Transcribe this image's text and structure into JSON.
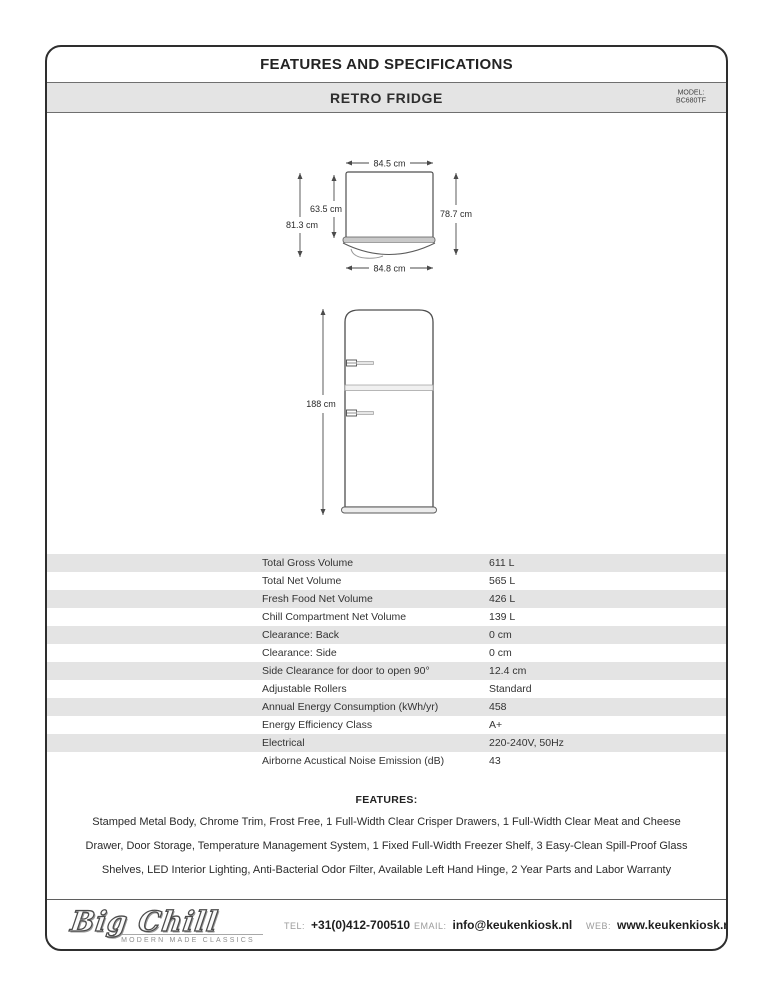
{
  "header": {
    "title": "FEATURES AND SPECIFICATIONS"
  },
  "product_bar": {
    "name": "RETRO FRIDGE",
    "model_label": "MODEL:",
    "model_value": "BC680TF"
  },
  "drawings": {
    "plan": {
      "width_top": "84.5 cm",
      "depth_body": "63.5 cm",
      "depth_total": "81.3 cm",
      "depth_right": "78.7 cm",
      "width_bottom": "84.8 cm"
    },
    "front": {
      "height": "188 cm"
    }
  },
  "specs": {
    "rows": [
      {
        "label": "Total Gross Volume",
        "value": "611 L"
      },
      {
        "label": "Total Net Volume",
        "value": "565 L"
      },
      {
        "label": "Fresh Food Net Volume",
        "value": "426 L"
      },
      {
        "label": "Chill Compartment Net Volume",
        "value": "139 L"
      },
      {
        "label": "Clearance: Back",
        "value": "0 cm"
      },
      {
        "label": "Clearance: Side",
        "value": "0 cm"
      },
      {
        "label": "Side Clearance for door to open 90°",
        "value": "12.4 cm"
      },
      {
        "label": "Adjustable Rollers",
        "value": "Standard"
      },
      {
        "label": "Annual Energy Consumption (kWh/yr)",
        "value": "458"
      },
      {
        "label": "Energy Efficiency Class",
        "value": "A+"
      },
      {
        "label": "Electrical",
        "value": "220-240V, 50Hz"
      },
      {
        "label": "Airborne Acustical Noise Emission (dB)",
        "value": "43"
      }
    ]
  },
  "features": {
    "heading": "FEATURES:",
    "text": "Stamped Metal Body, Chrome Trim, Frost Free, 1 Full-Width Clear Crisper Drawers, 1 Full-Width Clear Meat and Cheese Drawer, Door Storage, Temperature Management System, 1 Fixed Full-Width Freezer Shelf, 3 Easy-Clean Spill-Proof Glass Shelves, LED Interior Lighting, Anti-Bacterial Odor Filter, Available Left Hand Hinge, 2 Year Parts and Labor Warranty"
  },
  "footer": {
    "brand_script": "Big Chill",
    "brand_tagline": "MODERN MADE CLASSICS",
    "tel_label": "TEL:",
    "tel_value": "+31(0)412-700510",
    "email_label": "EMAIL:",
    "email_value": "info@keukenkiosk.nl",
    "web_label": "WEB:",
    "web_value": "www.keukenkiosk.nl"
  }
}
